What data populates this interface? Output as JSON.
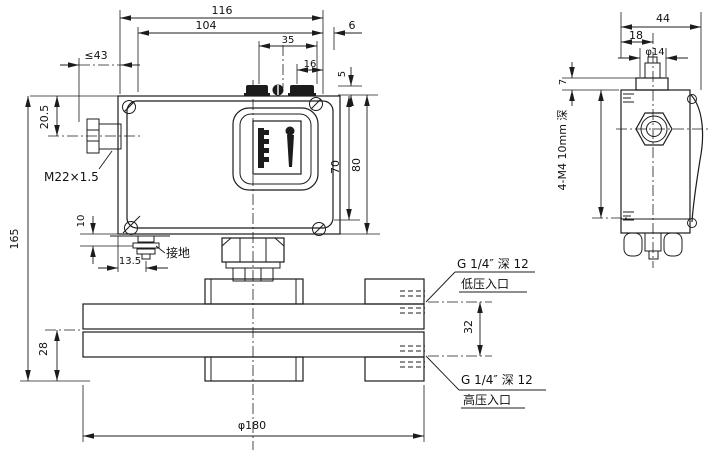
{
  "front_view": {
    "dims": {
      "overall_width": "116",
      "case_width": "104",
      "terminal_span": "35",
      "terminal_span_inner": "16",
      "right_offset": "6",
      "terminal_height": "5",
      "gland_length_max": "≤43",
      "gland_center_offset": "20.5",
      "overall_height": "165",
      "ground_v_offset": "10",
      "ground_h_offset": "13.5",
      "window_height": "70",
      "case_height": "80",
      "flange_thickness": "28",
      "port_spacing": "32",
      "flange_diameter": "φ180"
    },
    "labels": {
      "cable_gland_thread": "M22×1.5",
      "grounding": "接地",
      "low_pressure_thread": "G 1/4″ 深 12",
      "low_pressure_inlet": "低压入口",
      "high_pressure_thread": "G 1/4″ 深 12",
      "high_pressure_inlet": "高压入口"
    }
  },
  "side_view": {
    "dims": {
      "depth": "44",
      "gland_hole_offset": "18",
      "gland_hole_diameter": "φ14",
      "cap_step": "7",
      "mounting_holes": "4-M4 10mm 深"
    }
  }
}
